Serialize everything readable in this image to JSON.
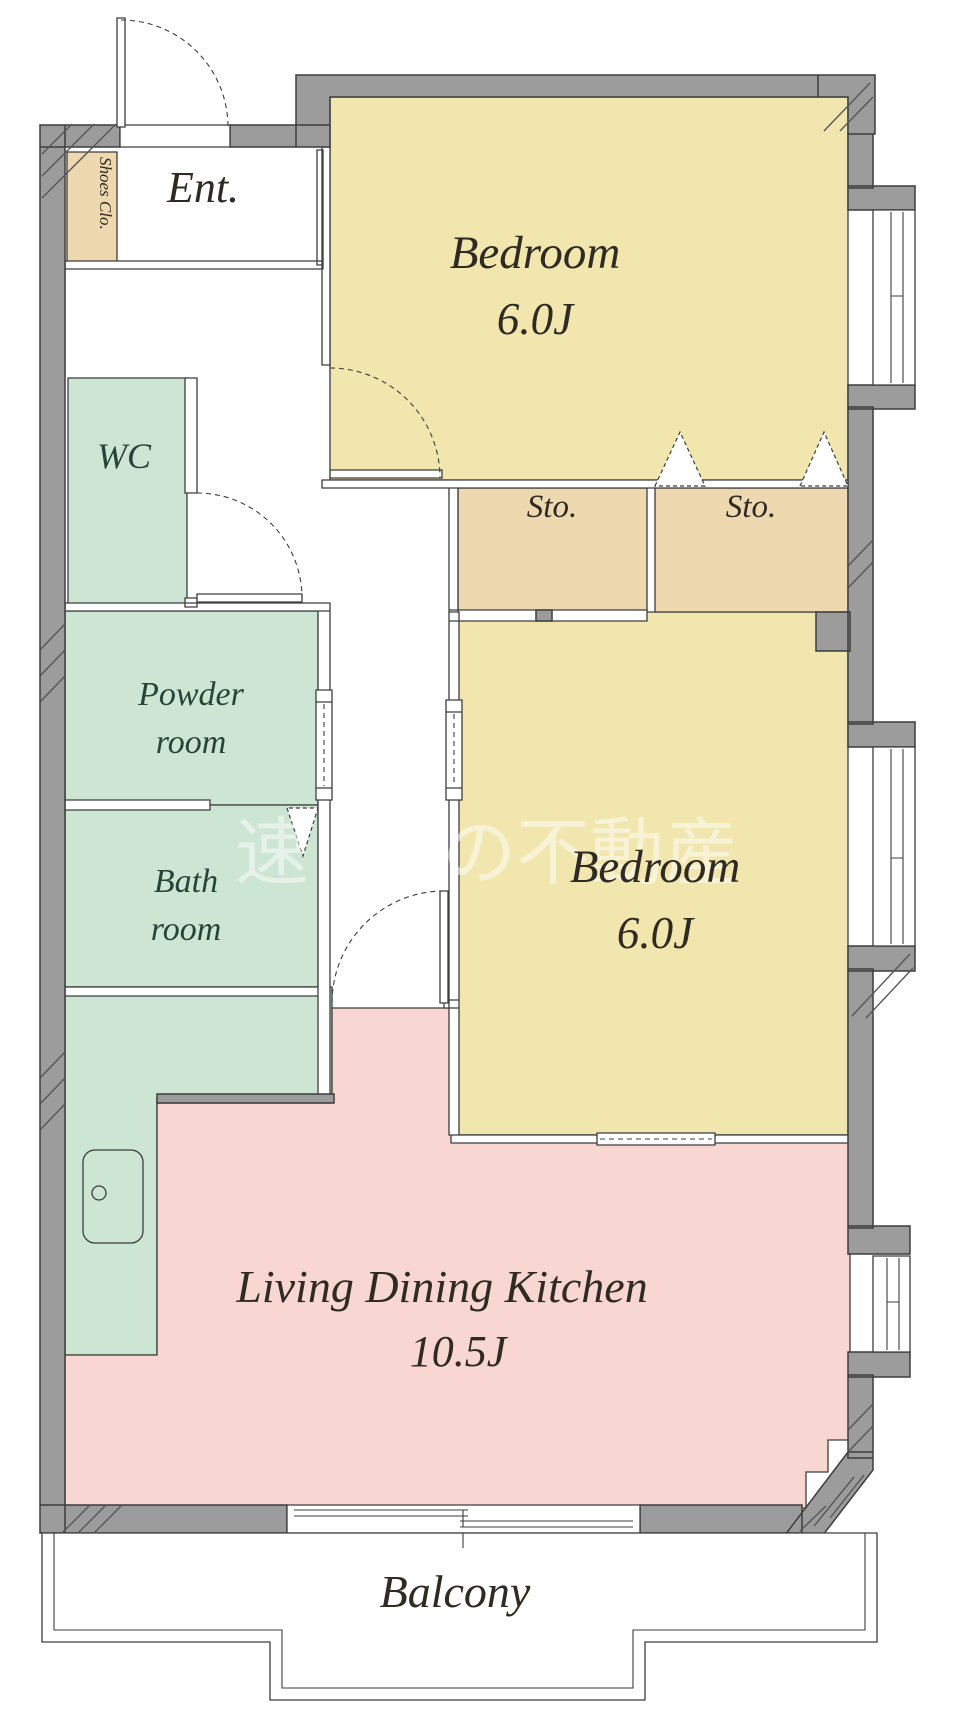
{
  "plan": {
    "type": "apartment-floor-plan",
    "rooms": {
      "entrance": {
        "label": "Ent."
      },
      "shoes_closet": {
        "label": "Shoes Clo."
      },
      "bedroom_top": {
        "label": "Bedroom",
        "area": "6.0J"
      },
      "bedroom_bottom": {
        "label": "Bedroom",
        "area": "6.0J"
      },
      "storage_left": {
        "label": "Sto."
      },
      "storage_right": {
        "label": "Sto."
      },
      "wc": {
        "label": "WC"
      },
      "powder_room": {
        "label_line1": "Powder",
        "label_line2": "room"
      },
      "bathroom": {
        "label_line1": "Bath",
        "label_line2": "room"
      },
      "ldk": {
        "label": "Living Dining Kitchen",
        "area": "10.5J"
      },
      "balcony": {
        "label": "Balcony"
      }
    },
    "watermark": {
      "part1": "速",
      "part2": "の不動産"
    },
    "colors": {
      "wall_gray": "#9c9c9c",
      "line_dark": "#3d3d3d",
      "room_yellow": "#f1e6ae",
      "room_tan": "#edd8b0",
      "room_green": "#cde6d3",
      "room_pink": "#f8d6d1",
      "label_dark": "#2f2a22",
      "label_green": "#26443a",
      "watermark_white": "#ffffff"
    }
  }
}
